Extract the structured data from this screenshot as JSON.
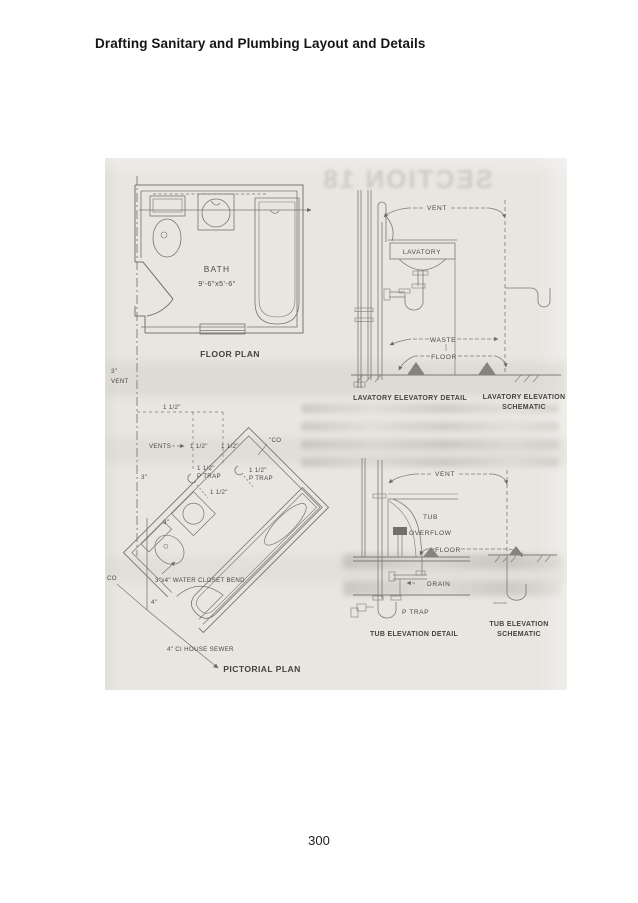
{
  "page": {
    "header_title": "Drafting Sanitary and Plumbing Layout and Details",
    "page_number": "300"
  },
  "figure": {
    "floor_plan": {
      "room_name": "BATH",
      "room_dimensions": "9'-6\"x5'-6\"",
      "caption": "FLOOR PLAN"
    },
    "lavatory_detail": {
      "vent_label": "VENT",
      "fixture_label": "LAVATORY",
      "waste_label": "WASTE",
      "floor_label": "FLOOR",
      "caption": "LAVATORY ELEVATORY DETAIL",
      "schematic_caption_line1": "LAVATORY ELEVATION",
      "schematic_caption_line2": "SCHEMATIC"
    },
    "pictorial_plan": {
      "stack_size": "3\"",
      "vent_label": "VENT",
      "vents_label": "VENTS",
      "pipe_size_1half": "1 1/2\"",
      "p_trap_label": "P TRAP",
      "cleanout_top": "\"CO",
      "cleanout_left": "CO",
      "stack_size_lower": "3\"",
      "branch_size": "3\"",
      "water_closet_bend": "3\"x4\" WATER CLOSET BEND",
      "soil_pipe_size": "4\"",
      "house_sewer": "4\" CI HOUSE SEWER",
      "caption": "PICTORIAL PLAN"
    },
    "tub_detail": {
      "vent_label": "VENT",
      "tub_label": "TUB",
      "overflow_label": "OVERFLOW",
      "floor_label": "FLOOR",
      "drain_label": "DRAIN",
      "p_trap_label": "P TRAP",
      "caption": "TUB ELEVATION DETAIL",
      "schematic_caption_line1": "TUB ELEVATION",
      "schematic_caption_line2": "SCHEMATIC"
    },
    "bleedthrough": {
      "mirrored_heading": "SECTION 18"
    }
  }
}
